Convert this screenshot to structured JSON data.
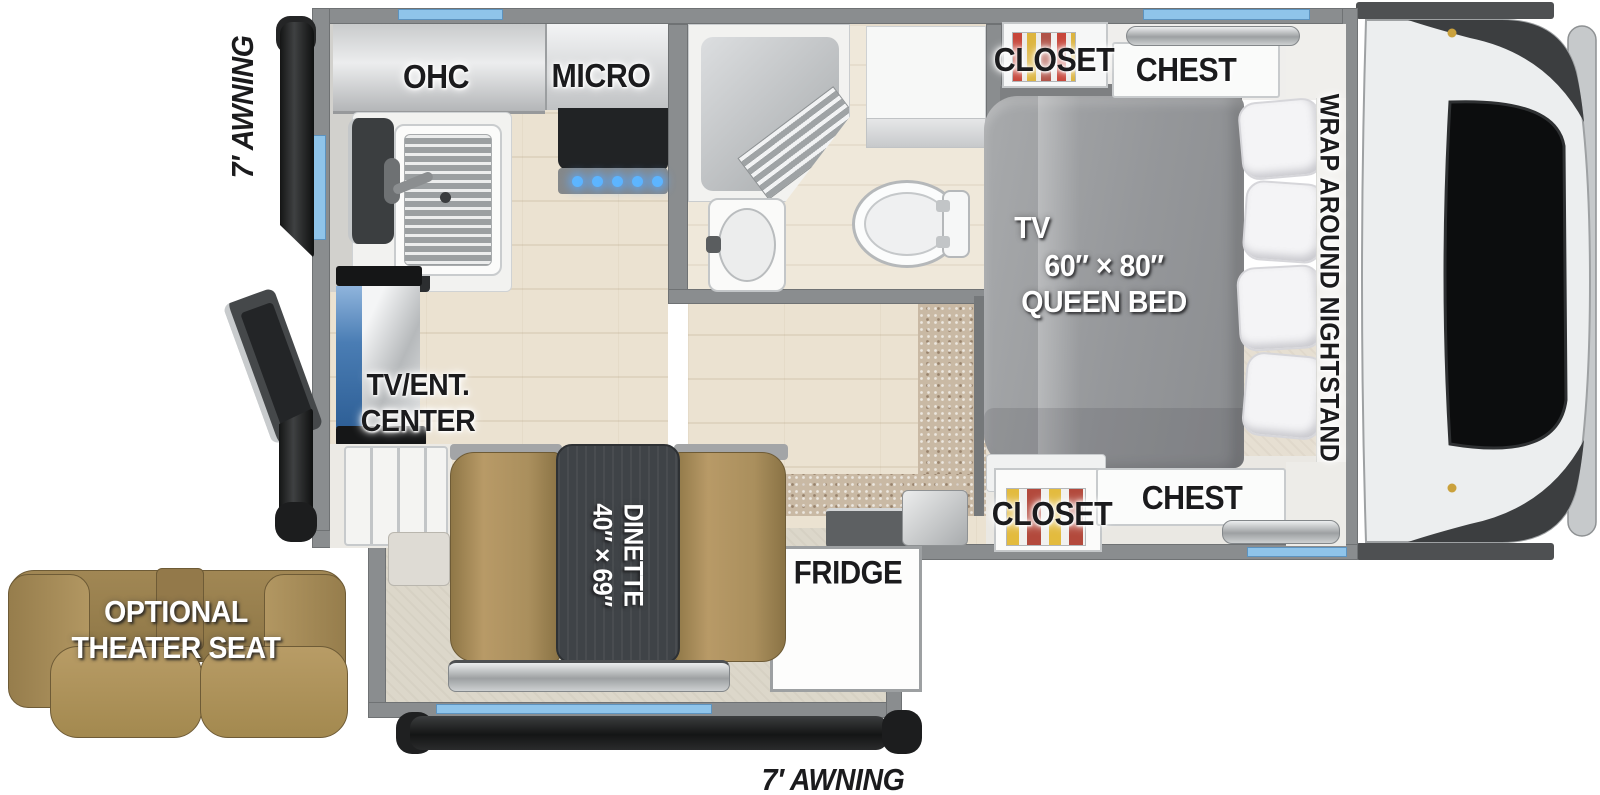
{
  "plan": {
    "awning_left": "7′ AWNING",
    "awning_bottom": "7′ AWNING",
    "kitchen": {
      "ohc": "OHC",
      "micro": "MICRO"
    },
    "bedroom": {
      "closet_top": "CLOSET",
      "chest_top": "CHEST",
      "closet_bottom": "CLOSET",
      "chest_bottom": "CHEST",
      "tv": "TV",
      "bed_line1": "60″ × 80″",
      "bed_line2": "QUEEN BED",
      "nightstand": "WRAP AROUND NIGHTSTAND"
    },
    "living": {
      "tv_ent_line1": "TV/ENT.",
      "tv_ent_line2": "CENTER",
      "dinette_name": "DINETTE",
      "dinette_size": "40″ × 69″",
      "fridge": "FRIDGE"
    },
    "theater": {
      "line1": "OPTIONAL",
      "line2": "THEATER SEAT"
    }
  },
  "colors": {
    "wall_gray": "#8a8d8f",
    "window_blue": "#8fc4ea",
    "floor_wood": "#ebe2d1",
    "carpet_beige": "#c9b9a4",
    "bed_gray": "#9c9ea0",
    "leather_tan": "#ab9060",
    "table_charcoal": "#3f4347",
    "awning_black": "#1b1c1d",
    "label_black": "#1b1b1d",
    "label_white": "#ffffff",
    "tv_screen_blue": "#4a7db4",
    "truck_dark": "#3c3e40"
  }
}
